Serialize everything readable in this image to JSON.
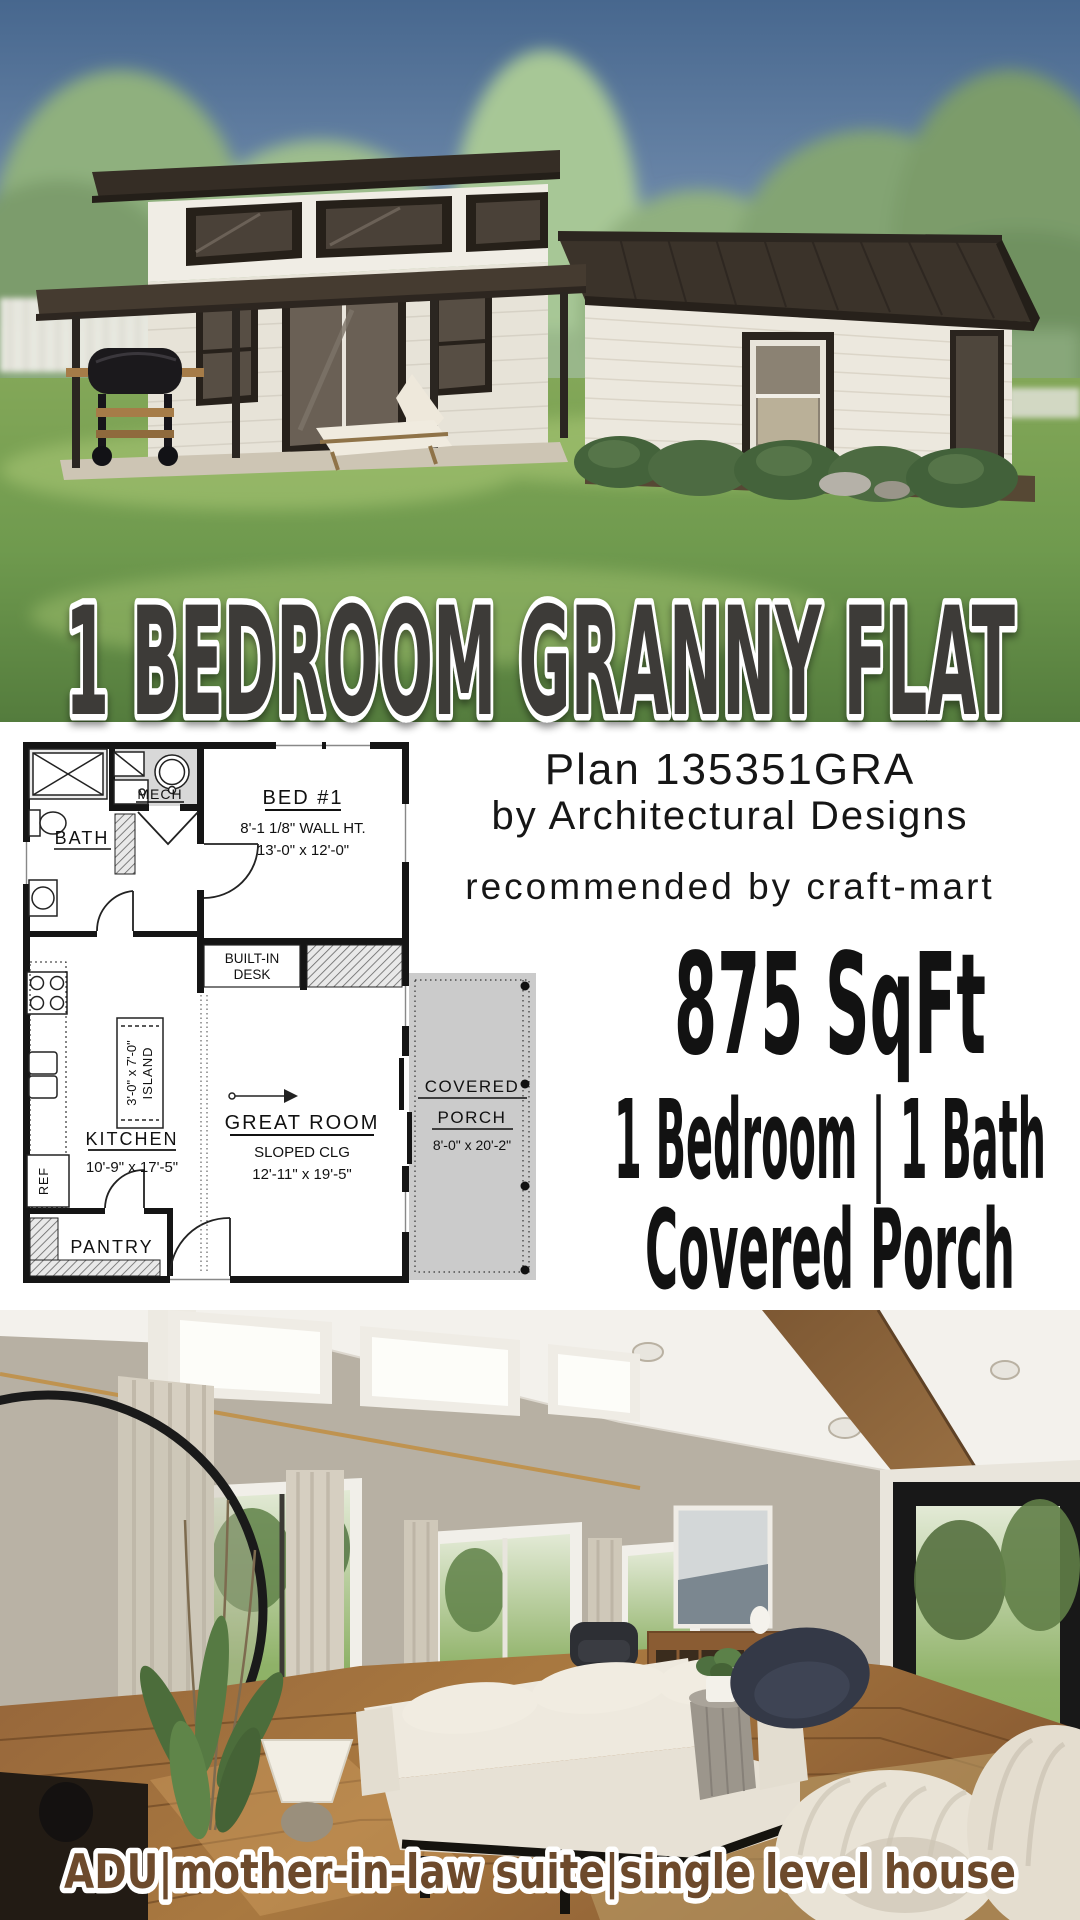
{
  "banner": {
    "title": "1 BEDROOM GRANNY FLAT"
  },
  "plan_info": {
    "plan_number": "Plan 135351GRA",
    "byline": "by Architectural Designs",
    "recommendation": "recommended by craft-mart"
  },
  "stats": {
    "area": "875 SqFt",
    "rooms": "1 Bedroom | 1 Bath",
    "feature": "Covered Porch"
  },
  "caption": {
    "text": "ADU|mother-in-law suite|single level house"
  },
  "floorplan": {
    "bath": {
      "label": "BATH"
    },
    "mech": {
      "label": "MECH"
    },
    "bedroom": {
      "label": "BED #1",
      "wall_height": "8'-1 1/8\" WALL HT.",
      "dims": "13'-0\" x 12'-0\""
    },
    "desk": {
      "line1": "BUILT-IN",
      "line2": "DESK"
    },
    "island": {
      "dims": "3'-0\" x 7'-0\"",
      "label": "ISLAND"
    },
    "great_room": {
      "label": "GREAT ROOM",
      "ceiling": "SLOPED CLG",
      "dims": "12'-11\" x 19'-5\""
    },
    "kitchen": {
      "label": "KITCHEN",
      "dims": "10'-9\" x 17'-5\""
    },
    "ref": {
      "label": "REF"
    },
    "pantry": {
      "label": "PANTRY"
    },
    "porch": {
      "line1": "COVERED",
      "line2": "PORCH",
      "dims": "8'-0\" x 20'-2\""
    }
  },
  "colors": {
    "title_dark": "#3d3b39",
    "caption_brown": "#6d4a2c",
    "porch_gray": "#cbcbcb",
    "roof_brown": "#3b332a",
    "sky_blue": "#47678e",
    "grass_green": "#6f9a4e"
  }
}
